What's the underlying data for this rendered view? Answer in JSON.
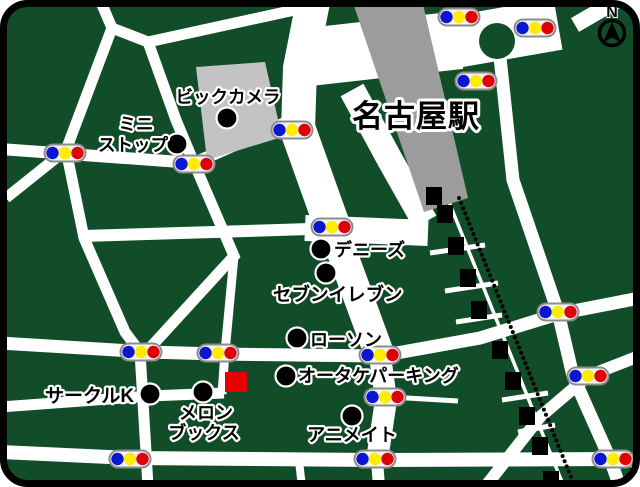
{
  "canvas": {
    "width": 640,
    "height": 487
  },
  "colors": {
    "land": "#114d28",
    "road": "#ffffff",
    "station_building": "#9c9c9c",
    "store_building": "#c3c3c3",
    "border": "#000000",
    "signal_body": "#f4f4f4",
    "signal_border": "#8c8c8c",
    "signal_blue": "#0b16d0",
    "signal_yellow": "#ffec00",
    "signal_red": "#dd0008",
    "landmark_dot": "#000000",
    "destination_red": "#e80000",
    "railway_black": "#000000"
  },
  "station": {
    "label": "名古屋駅",
    "x": 416,
    "y": 127,
    "size": 31,
    "building": "352,0 422,0 468,198 424,212"
  },
  "bic_building": "196,67 265,62 282,137 207,160",
  "roundabout": {
    "cx": 497,
    "cy": 41,
    "r": 18
  },
  "landmarks": [
    {
      "id": "bic-camera",
      "dot": [
        227,
        118
      ],
      "lines": [
        {
          "text": "ビックカメラ",
          "x": 228,
          "y": 103,
          "anchor": "middle",
          "size": 17.5
        }
      ]
    },
    {
      "id": "mini-stop",
      "dot": [
        177,
        144
      ],
      "lines": [
        {
          "text": "ミニ",
          "x": 136,
          "y": 130,
          "anchor": "middle",
          "size": 17.5
        },
        {
          "text": "ストップ",
          "x": 133,
          "y": 151,
          "anchor": "middle",
          "size": 17.5
        }
      ]
    },
    {
      "id": "dennys",
      "dot": [
        321,
        249
      ],
      "lines": [
        {
          "text": "デニーズ",
          "x": 334,
          "y": 256,
          "anchor": "start",
          "size": 18
        }
      ]
    },
    {
      "id": "seven-eleven",
      "dot": [
        326,
        273
      ],
      "lines": [
        {
          "text": "セブンイレブン",
          "x": 273,
          "y": 301,
          "anchor": "start",
          "size": 18.5
        }
      ]
    },
    {
      "id": "lawson",
      "dot": [
        297,
        338
      ],
      "lines": [
        {
          "text": "ローソン",
          "x": 310,
          "y": 346,
          "anchor": "start",
          "size": 18
        }
      ]
    },
    {
      "id": "otake-parking",
      "dot": [
        286,
        376
      ],
      "lines": [
        {
          "text": "オータケパーキング",
          "x": 298,
          "y": 382,
          "anchor": "start",
          "size": 18
        }
      ]
    },
    {
      "id": "circle-k",
      "dot": [
        150,
        394
      ],
      "lines": [
        {
          "text": "サークルK",
          "x": 45,
          "y": 402,
          "anchor": "start",
          "size": 19
        }
      ]
    },
    {
      "id": "melon-books",
      "dot": [
        203,
        392
      ],
      "lines": [
        {
          "text": "メロン",
          "x": 206,
          "y": 419,
          "anchor": "middle",
          "size": 18
        },
        {
          "text": "ブックス",
          "x": 204,
          "y": 439,
          "anchor": "middle",
          "size": 18
        }
      ]
    },
    {
      "id": "animate",
      "dot": [
        352,
        416
      ],
      "lines": [
        {
          "text": "アニメイト",
          "x": 352,
          "y": 441,
          "anchor": "middle",
          "size": 18
        }
      ]
    }
  ],
  "destination": {
    "x": 225,
    "y": 372,
    "w": 22,
    "h": 20
  },
  "signals": [
    [
      459,
      17
    ],
    [
      535,
      28
    ],
    [
      476,
      81
    ],
    [
      292,
      130
    ],
    [
      65,
      153
    ],
    [
      194,
      164
    ],
    [
      332,
      227
    ],
    [
      558,
      312
    ],
    [
      141,
      352
    ],
    [
      218,
      353
    ],
    [
      380,
      355
    ],
    [
      588,
      376
    ],
    [
      385,
      397
    ],
    [
      130,
      459
    ],
    [
      375,
      459
    ],
    [
      613,
      459
    ]
  ],
  "signal_size": {
    "w": 41,
    "h": 17,
    "dot_r": 6.2,
    "dx": 12.5
  },
  "roads": [
    {
      "d": "M100,0 L112,28",
      "w": 11
    },
    {
      "d": "M112,28 L66,150",
      "w": 11
    },
    {
      "d": "M66,150 L6,198",
      "w": 11
    },
    {
      "d": "M112,28 L148,42",
      "w": 11
    },
    {
      "d": "M148,42 L322,4",
      "w": 11
    },
    {
      "d": "M148,42 L176,120 L194,163",
      "w": 11
    },
    {
      "d": "M0,149 L194,163",
      "w": 12
    },
    {
      "d": "M194,163 L310,112",
      "w": 12
    },
    {
      "d": "M66,150 L84,238 L125,332 L140,352 L146,452 L148,487",
      "w": 11
    },
    {
      "d": "M194,163 L234,256 L148,350",
      "w": 11
    },
    {
      "d": "M234,256 L225,352 L222,394",
      "w": 9
    },
    {
      "d": "M0,343 L148,352 L218,354 L380,356 L480,338 L558,314 L640,298",
      "w": 13
    },
    {
      "d": "M83,236 L310,229",
      "w": 12
    },
    {
      "d": "M305,228 L428,233",
      "w": 26
    },
    {
      "d": "M313,2 L300,68 L298,130",
      "w": 34
    },
    {
      "d": "M298,130 L333,228",
      "w": 36
    },
    {
      "d": "M333,228 L380,356",
      "w": 30
    },
    {
      "d": "M380,356 L386,400 L377,460",
      "w": 22
    },
    {
      "d": "M377,460 L379,487",
      "w": 12
    },
    {
      "d": "M300,58 L460,40",
      "w": 58
    },
    {
      "d": "M455,42 L558,24",
      "w": 52
    },
    {
      "d": "M575,25 L618,0",
      "w": 16
    },
    {
      "d": "M352,90 L390,160 L425,222",
      "w": 26
    },
    {
      "d": "M499,48 L513,180 L558,312 L573,376 L610,459 L620,487",
      "w": 13
    },
    {
      "d": "M642,355 L588,376 L540,417 L485,487",
      "w": 12
    },
    {
      "d": "M0,452 L130,458 L375,460 L614,459 L640,461",
      "w": 14
    },
    {
      "d": "M0,407 L150,396 L224,393",
      "w": 11
    },
    {
      "d": "M299,461 L302,487",
      "w": 8
    },
    {
      "d": "M390,397 L458,401",
      "w": 5
    },
    {
      "d": "M430,253 L485,245",
      "w": 5
    },
    {
      "d": "M445,291 L498,283",
      "w": 5
    },
    {
      "d": "M456,322 L502,315",
      "w": 5
    },
    {
      "d": "M502,400 L548,393",
      "w": 5
    },
    {
      "d": "M518,432 L555,425",
      "w": 5
    },
    {
      "d": "M449,202 L562,482",
      "w": 3.5
    }
  ],
  "railway": {
    "dashes": [
      [
        434,
        196
      ],
      [
        445,
        214
      ],
      [
        456,
        246
      ],
      [
        468,
        278
      ],
      [
        479,
        310
      ],
      [
        500,
        350
      ],
      [
        513,
        381
      ],
      [
        527,
        416
      ],
      [
        540,
        446
      ],
      [
        551,
        480
      ]
    ],
    "dash_w": 16,
    "dash_h": 18,
    "dotted": {
      "x1": 459,
      "y1": 198,
      "x2": 575,
      "y2": 487,
      "r": 2,
      "step": 5.5
    }
  },
  "compass": {
    "label": "N",
    "x": 612,
    "n_y": 17,
    "cx": 612,
    "cy": 33,
    "r": 12.5,
    "triangle": "612,22 621.5,43 612,37.5 602.5,43"
  },
  "frame": {
    "x": 3.5,
    "y": 3.5,
    "w": 633,
    "h": 480,
    "rx": 24,
    "stroke_w": 7
  }
}
